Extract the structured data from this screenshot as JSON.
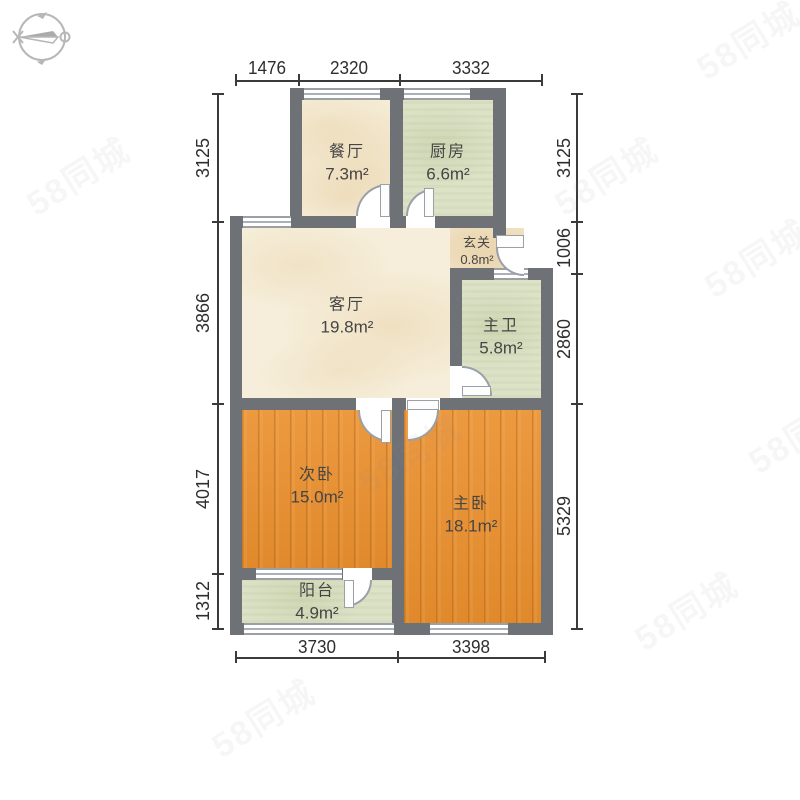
{
  "watermark": {
    "text": "58同城"
  },
  "compass": {
    "name": "compass-pointing-west"
  },
  "rooms": [
    {
      "id": "dining",
      "name": "餐厅",
      "area": "7.3m²"
    },
    {
      "id": "kitchen",
      "name": "厨房",
      "area": "6.6m²"
    },
    {
      "id": "entry",
      "name": "玄关",
      "area": "0.8m²"
    },
    {
      "id": "living",
      "name": "客厅",
      "area": "19.8m²"
    },
    {
      "id": "master-bath",
      "name": "主卫",
      "area": "5.8m²"
    },
    {
      "id": "second-bedroom",
      "name": "次卧",
      "area": "15.0m²"
    },
    {
      "id": "master-bedroom",
      "name": "主卧",
      "area": "18.1m²"
    },
    {
      "id": "balcony",
      "name": "阳台",
      "area": "4.9m²"
    }
  ],
  "dimensions": {
    "top": [
      "1476",
      "2320",
      "3332"
    ],
    "left": [
      "3125",
      "3866",
      "4017",
      "1312"
    ],
    "right": [
      "3125",
      "1006",
      "2860",
      "5329"
    ],
    "bottom": [
      "3730",
      "3398"
    ]
  },
  "colors": {
    "wall": "#6e7277",
    "floor_marble": "#f6eeda",
    "floor_tile": "#dce2c6",
    "floor_wood": "#e8913a",
    "dimension_text": "#2e2e2e"
  }
}
